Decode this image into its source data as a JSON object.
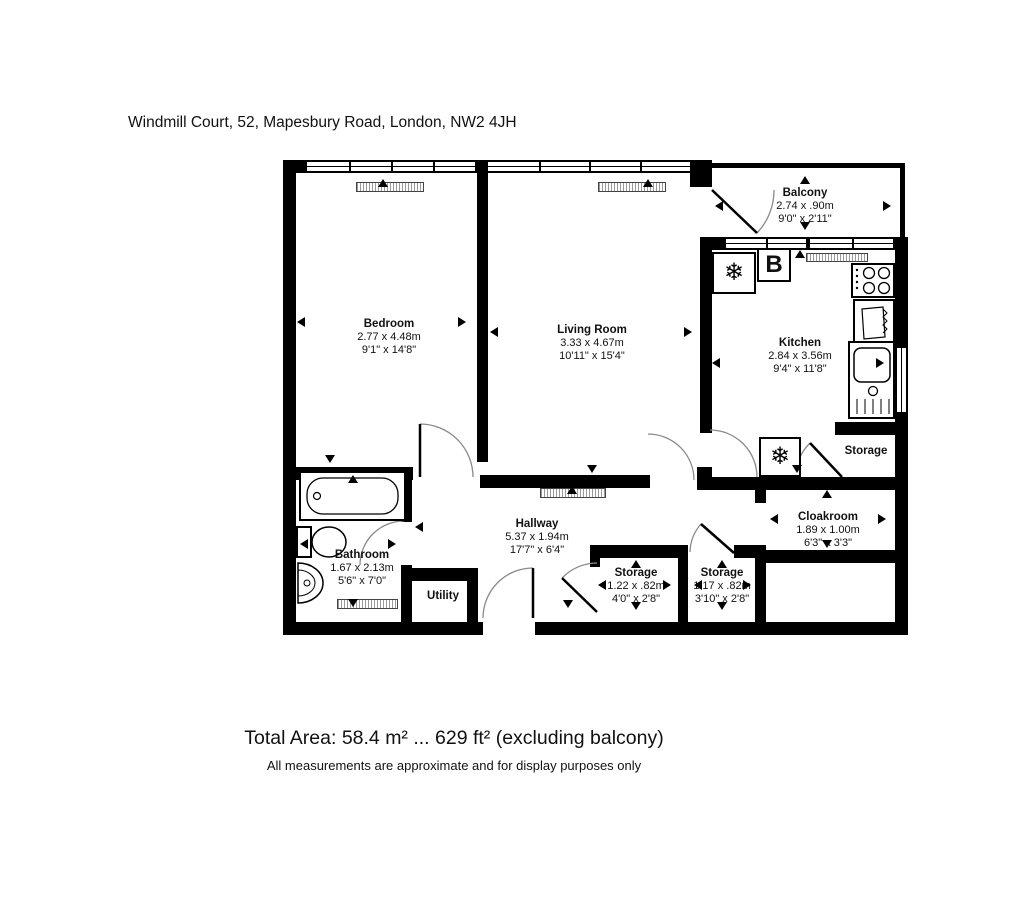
{
  "header": {
    "address": "Windmill Court, 52, Mapesbury Road, London, NW2 4JH"
  },
  "rooms": [
    {
      "name": "Bedroom",
      "metric": "2.77 x 4.48m",
      "imperial": "9'1\" x 14'8\""
    },
    {
      "name": "Living Room",
      "metric": "3.33 x 4.67m",
      "imperial": "10'11\" x 15'4\""
    },
    {
      "name": "Kitchen",
      "metric": "2.84 x 3.56m",
      "imperial": "9'4\" x 11'8\""
    },
    {
      "name": "Balcony",
      "metric": "2.74 x .90m",
      "imperial": "9'0\" x 2'11\""
    },
    {
      "name": "Bathroom",
      "metric": "1.67 x 2.13m",
      "imperial": "5'6\" x 7'0\""
    },
    {
      "name": "Hallway",
      "metric": "5.37 x 1.94m",
      "imperial": "17'7\" x 6'4\""
    },
    {
      "name": "Utility"
    },
    {
      "name": "Storage",
      "metric": "1.22 x .82m",
      "imperial": "4'0\" x 2'8\""
    },
    {
      "name": "Storage",
      "metric": "1.17 x .82m",
      "imperial": "3'10\" x 2'8\""
    },
    {
      "name": "Storage"
    },
    {
      "name": "Cloakroom",
      "metric": "1.89 x 1.00m",
      "imperial": "6'3\" x 3'3\""
    }
  ],
  "fixtures": {
    "boiler_label": "B",
    "freezer_icon": "❄",
    "fridge_icon": "❄"
  },
  "footer": {
    "total_area": "Total Area: 58.4 m² ... 629 ft² (excluding balcony)",
    "disclaimer": "All measurements are approximate and for display purposes only"
  },
  "colors": {
    "wall": "#000000",
    "background": "#ffffff",
    "door_arc": "#8a8a8a"
  }
}
